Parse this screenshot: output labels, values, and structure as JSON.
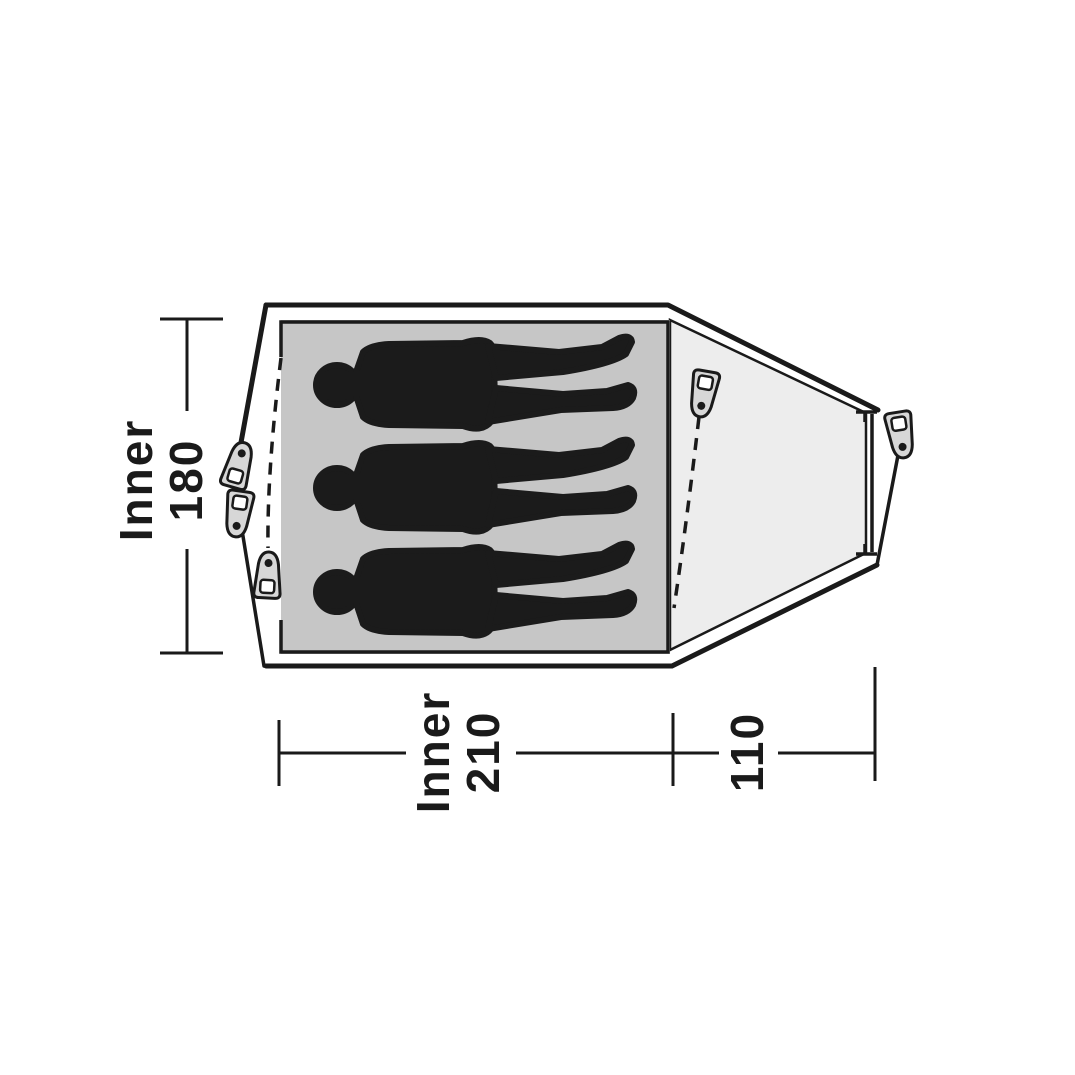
{
  "diagram": {
    "kind": "tent-floorplan-top-view",
    "person_count": 3,
    "labels": {
      "inner_width": {
        "word": "Inner",
        "value": "180"
      },
      "inner_length": {
        "word": "Inner",
        "value": "210"
      },
      "vestibule_depth": {
        "value": "110"
      }
    },
    "dimensions_cm": {
      "inner_width": 180,
      "inner_length": 210,
      "vestibule_depth": 110
    },
    "colors": {
      "background": "#ffffff",
      "line": "#1a1a1a",
      "inner_floor": "#c6c6c6",
      "vestibule": "#ededed",
      "silhouette": "#1b1b1b",
      "peg_fill": "#d7d7d7"
    }
  }
}
